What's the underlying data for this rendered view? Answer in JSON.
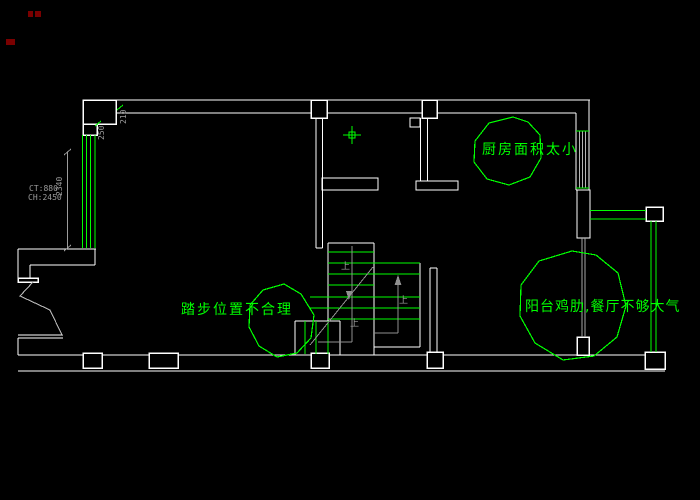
{
  "drawing": {
    "background": "#000000",
    "colors": {
      "wall": "#ffffff",
      "annotation_green": "#00ff00",
      "dimension_gray": "#9c9c9c",
      "window_gray": "#b4b4b4",
      "red_mark": "#7a0000"
    },
    "annotations": {
      "kitchen_label": "厨房面积太小",
      "stairs_label": "踏步位置不合理",
      "dining_label": "阳台鸡肋,餐厅不够大气"
    },
    "dimensions": {
      "ct": "CT:880",
      "ch": "CH:2450",
      "left_height": "2340",
      "corner_a": "250",
      "corner_b": "210"
    },
    "stairs": {
      "up_label": "上"
    }
  }
}
